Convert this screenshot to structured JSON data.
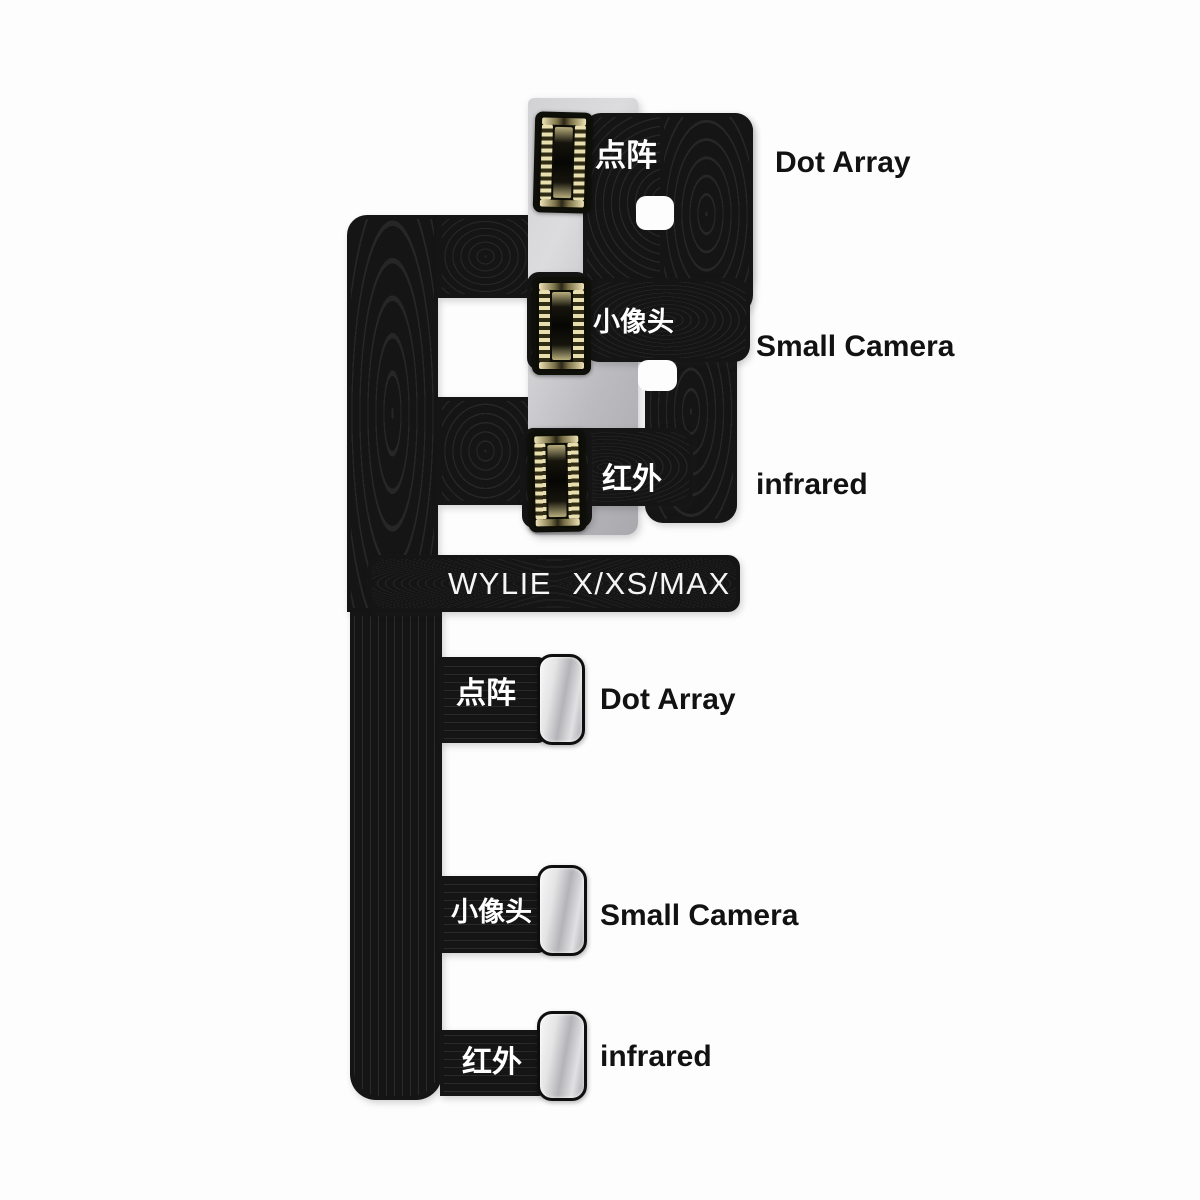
{
  "model_text": "WYLIE  X/XS/MAX",
  "upper_section": {
    "description": "flex applied on metal stiffener with FPC connectors",
    "labels": [
      {
        "cn": "点阵",
        "en": "Dot Array"
      },
      {
        "cn": "小像头",
        "en": "Small Camera"
      },
      {
        "cn": "红外",
        "en": "infrared"
      }
    ]
  },
  "lower_section": {
    "description": "bare flex tail with solder pads",
    "labels": [
      {
        "cn": "点阵",
        "en": "Dot Array"
      },
      {
        "cn": "小像头",
        "en": "Small Camera"
      },
      {
        "cn": "红外",
        "en": "infrared"
      }
    ]
  },
  "colors": {
    "background": "#fdfdfd",
    "flex_black": "#151515",
    "stiffener_gray": "#c4c4c8",
    "pad_silver": "#d9d9db",
    "connector_gold": "#e2d8a8",
    "label_text": "#121212",
    "flex_text": "#ffffff"
  }
}
